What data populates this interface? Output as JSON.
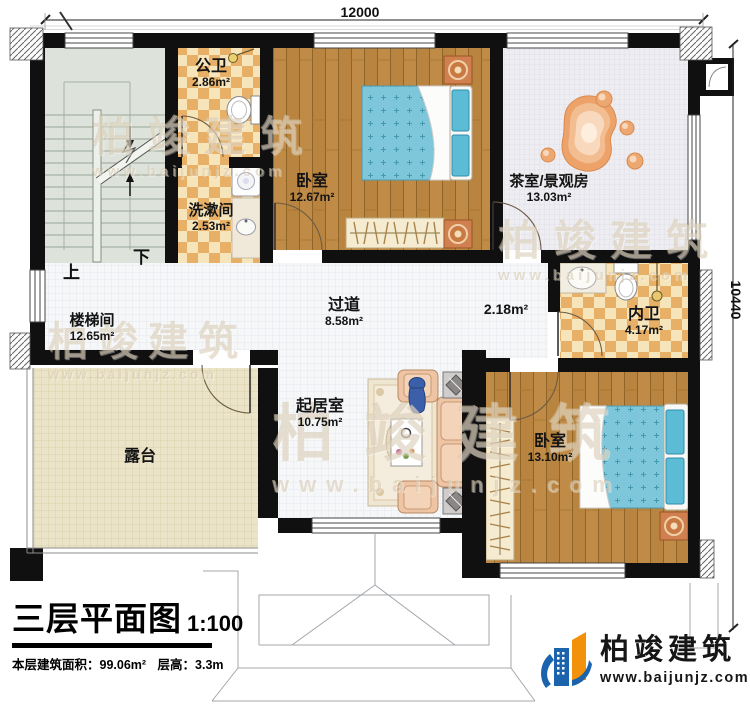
{
  "plan": {
    "dimensions": {
      "width": "12000",
      "height": "10440"
    },
    "stairs": {
      "up": "上",
      "down": "下"
    },
    "rooms": {
      "public_bath": {
        "name": "公卫",
        "area": "2.86m²"
      },
      "washroom": {
        "name": "洗漱间",
        "area": "2.53m²"
      },
      "bedroom_top": {
        "name": "卧室",
        "area": "12.67m²"
      },
      "tea_room": {
        "name": "茶室/景观房",
        "area": "13.03m²"
      },
      "stairwell": {
        "name": "楼梯间",
        "area": "12.65m²"
      },
      "corridor": {
        "name": "过道",
        "area": "8.58m²"
      },
      "closet_nook": {
        "area": "2.18m²"
      },
      "ensuite_bath": {
        "name": "内卫",
        "area": "4.17m²"
      },
      "bedroom_bottom": {
        "name": "卧室",
        "area": "13.10m²"
      },
      "living_room": {
        "name": "起居室",
        "area": "10.75m²"
      },
      "terrace": {
        "name": "露台"
      }
    }
  },
  "title_block": {
    "title": "三层平面图",
    "scale": "1:100",
    "stats_area": "本层建筑面积：99.06m²",
    "stats_height": "层高：3.3m"
  },
  "brand": {
    "name": "柏竣建筑",
    "url": "www.baijunjz.com"
  },
  "watermark": {
    "name": "柏竣建筑",
    "url": "www.baijunjz.com"
  },
  "colors": {
    "wall": "#101010",
    "logo_blue": "#1b63ad",
    "logo_orange": "#f28c0d",
    "bed": "#7ec7da",
    "nightstand": "#d0804e",
    "checker_floor": "#e7b066",
    "wood_floor": "#b8843f"
  }
}
